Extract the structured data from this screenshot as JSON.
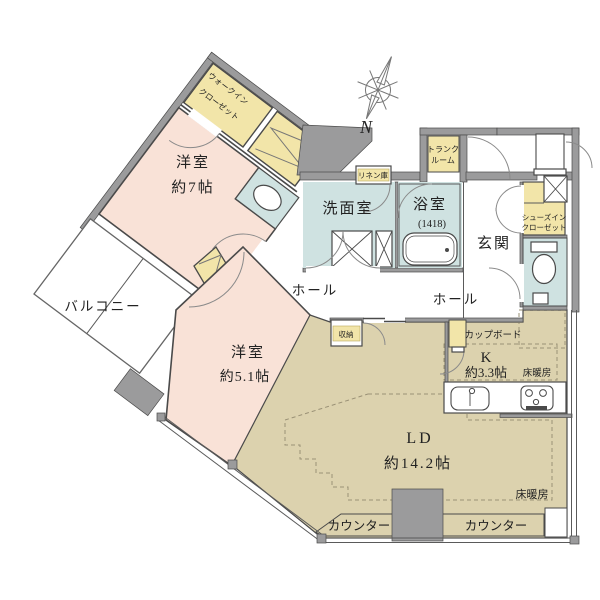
{
  "plan": {
    "type": "apartment-floor-plan",
    "compass": "N",
    "rooms": {
      "western_room_7": {
        "name": "洋室",
        "size": "約7帖"
      },
      "western_room_51": {
        "name": "洋室",
        "size": "約5.1帖"
      },
      "living_dining": {
        "name": "LD",
        "size": "約14.2帖"
      },
      "kitchen": {
        "name": "K",
        "size": "約3.3帖"
      },
      "washroom": {
        "name": "洗面室"
      },
      "bathroom": {
        "name": "浴室",
        "size": "(1418)"
      },
      "entrance": {
        "name": "玄関"
      },
      "hall_west": {
        "name": "ホール"
      },
      "hall_east": {
        "name": "ホール"
      },
      "balcony": {
        "name": "バルコニー"
      }
    },
    "storage": {
      "walk_in_closet": {
        "line1": "ウォークイン",
        "line2": "クローゼット"
      },
      "shoes_in_closet": {
        "line1": "シューズイン",
        "line2": "クローゼット"
      },
      "trunk_room": {
        "line1": "トランク",
        "line2": "ルーム"
      },
      "linen": "リネン庫",
      "storage_box": "収納",
      "cupboard": "カップボード"
    },
    "features": {
      "floor_heating_kitchen": "床暖房",
      "floor_heating_ld": "床暖房",
      "counter_left": "カウンター",
      "counter_right": "カウンター"
    },
    "palette": {
      "wall": "#9b9b9c",
      "line": "#4a4a4a",
      "room_pink": "#f9e2d7",
      "floor_beige": "#dcd2ae",
      "wet_blue": "#cfe2e1",
      "closet_yellow": "#f2e5a9"
    }
  }
}
